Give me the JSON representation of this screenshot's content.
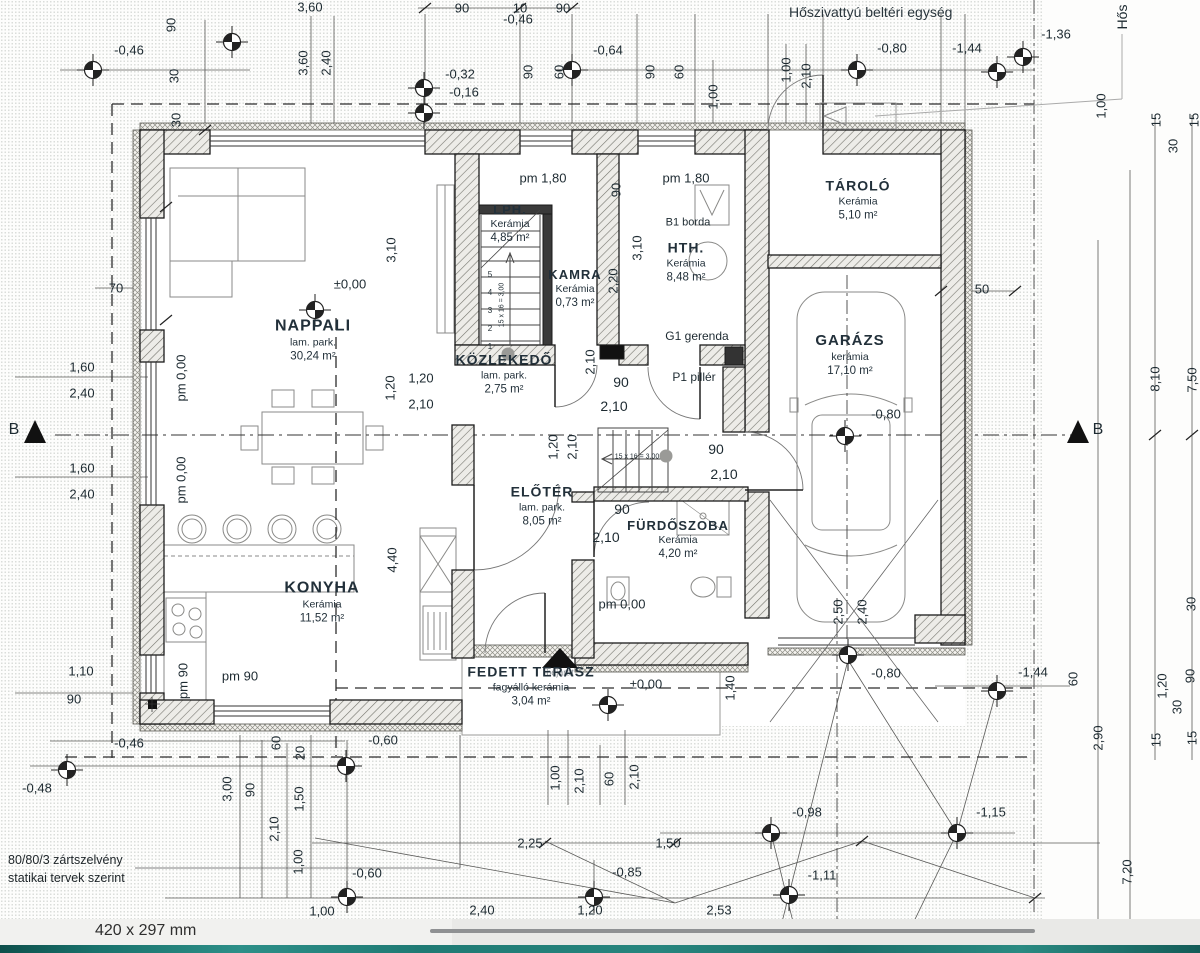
{
  "notes": {
    "hvac": "Hőszivattyú beltéri egység",
    "structural_line1": "80/80/3 zártszelvény",
    "structural_line2": "statikai tervek szerint"
  },
  "statusbar": {
    "paper_size": "420 x 297 mm"
  },
  "colors": {
    "paper": "#fdfdfc",
    "ink": "#1d2a31",
    "hatch": "#76766f",
    "teal_strip": "#1f7a74"
  },
  "rooms": [
    {
      "name": "NAPPALI",
      "finish": "lam. park.",
      "area": "30,24 m²",
      "x": 313,
      "y": 340,
      "ns": 16
    },
    {
      "name": "KONYHA",
      "finish": "Kerámia",
      "area": "11,52 m²",
      "x": 322,
      "y": 602,
      "ns": 16
    },
    {
      "name": "KÖZLEKEDŐ",
      "finish": "lam. park.",
      "area": "2,75 m²",
      "x": 504,
      "y": 374,
      "ns": 14
    },
    {
      "name": "LPH.",
      "finish": "Kerámia",
      "area": "4,85 m²",
      "x": 510,
      "y": 224,
      "ns": 13
    },
    {
      "name": "KAMRA",
      "finish": "Kerámia",
      "area": "0,73 m²",
      "x": 575,
      "y": 289,
      "ns": 13
    },
    {
      "name": "HTH.",
      "finish": "Kerámia",
      "area": "8,48 m²",
      "x": 686,
      "y": 262,
      "ns": 14
    },
    {
      "name": "TÁROLÓ",
      "finish": "Kerámia",
      "area": "5,10 m²",
      "x": 858,
      "y": 200,
      "ns": 14
    },
    {
      "name": "GARÁZS",
      "finish": "kerámia",
      "area": "17,10 m²",
      "x": 850,
      "y": 355,
      "ns": 15
    },
    {
      "name": "ELŐTÉR",
      "finish": "lam. park.",
      "area": "8,05 m²",
      "x": 542,
      "y": 506,
      "ns": 14
    },
    {
      "name": "FÜRDŐSZOBA",
      "finish": "Kerámia",
      "area": "4,20 m²",
      "x": 678,
      "y": 540,
      "ns": 13
    },
    {
      "name": "FEDETT TERASZ",
      "finish": "fagyálló kerámia",
      "area": "3,04 m²",
      "x": 531,
      "y": 686,
      "ns": 14
    }
  ],
  "labels": [
    {
      "t": "3,60",
      "x": 310,
      "y": 7
    },
    {
      "t": "90",
      "x": 462,
      "y": 8
    },
    {
      "t": "10",
      "x": 520,
      "y": 8
    },
    {
      "t": "90",
      "x": 563,
      "y": 8
    },
    {
      "t": "-0,46",
      "x": 518,
      "y": 19
    },
    {
      "t": "-0,46",
      "x": 129,
      "y": 50
    },
    {
      "t": "-0,64",
      "x": 608,
      "y": 50
    },
    {
      "t": "-0,32",
      "x": 460,
      "y": 74
    },
    {
      "t": "-0,16",
      "x": 464,
      "y": 92
    },
    {
      "t": "-0,80",
      "x": 892,
      "y": 48
    },
    {
      "t": "-1,44",
      "x": 967,
      "y": 48
    },
    {
      "t": "-1,36",
      "x": 1056,
      "y": 34
    },
    {
      "t": "-0,80",
      "x": 886,
      "y": 673
    },
    {
      "t": "-1,44",
      "x": 1033,
      "y": 672
    },
    {
      "t": "70",
      "x": 116,
      "y": 288
    },
    {
      "t": "1,60",
      "x": 82,
      "y": 367
    },
    {
      "t": "2,40",
      "x": 82,
      "y": 393
    },
    {
      "t": "1,60",
      "x": 82,
      "y": 468
    },
    {
      "t": "2,40",
      "x": 82,
      "y": 494
    },
    {
      "t": "1,10",
      "x": 81,
      "y": 671
    },
    {
      "t": "90",
      "x": 74,
      "y": 699
    },
    {
      "t": "-0,46",
      "x": 129,
      "y": 743
    },
    {
      "t": "-0,48",
      "x": 37,
      "y": 788
    },
    {
      "t": "pm 90",
      "x": 240,
      "y": 676
    },
    {
      "t": "±0,00",
      "x": 350,
      "y": 284
    },
    {
      "t": "pm 1,80",
      "x": 543,
      "y": 178
    },
    {
      "t": "pm 1,80",
      "x": 686,
      "y": 178
    },
    {
      "t": "50",
      "x": 982,
      "y": 289
    },
    {
      "t": "-0,80",
      "x": 886,
      "y": 414
    },
    {
      "t": "B1 borda",
      "x": 688,
      "y": 223,
      "s": 11
    },
    {
      "t": "G1 gerenda",
      "x": 697,
      "y": 336,
      "s": 12
    },
    {
      "t": "P1 pillér",
      "x": 694,
      "y": 377,
      "s": 12
    },
    {
      "t": "90",
      "x": 621,
      "y": 382,
      "s": 14
    },
    {
      "t": "2,10",
      "x": 614,
      "y": 406,
      "s": 14
    },
    {
      "t": "90",
      "x": 716,
      "y": 449,
      "s": 14
    },
    {
      "t": "2,10",
      "x": 724,
      "y": 474,
      "s": 14
    },
    {
      "t": "90",
      "x": 622,
      "y": 509,
      "s": 14
    },
    {
      "t": "2,10",
      "x": 606,
      "y": 537,
      "s": 14
    },
    {
      "t": "1,20",
      "x": 421,
      "y": 378
    },
    {
      "t": "2,10",
      "x": 421,
      "y": 404
    },
    {
      "t": "pm 0,00",
      "x": 622,
      "y": 604
    },
    {
      "t": "±0,00",
      "x": 646,
      "y": 684
    },
    {
      "t": "bejárat",
      "x": 560,
      "y": 673,
      "s": 9,
      "c": "#8a9096"
    },
    {
      "t": "-0,60",
      "x": 383,
      "y": 740
    },
    {
      "t": "-0,60",
      "x": 367,
      "y": 873
    },
    {
      "t": "-0,85",
      "x": 627,
      "y": 872
    },
    {
      "t": "2,25",
      "x": 530,
      "y": 843
    },
    {
      "t": "1,50",
      "x": 668,
      "y": 843
    },
    {
      "t": "-0,98",
      "x": 807,
      "y": 812
    },
    {
      "t": "-1,15",
      "x": 991,
      "y": 812
    },
    {
      "t": "-1,11",
      "x": 822,
      "y": 875
    },
    {
      "t": "1,00",
      "x": 322,
      "y": 911
    },
    {
      "t": "2,40",
      "x": 482,
      "y": 910
    },
    {
      "t": "1,20",
      "x": 590,
      "y": 910
    },
    {
      "t": "2,53",
      "x": 719,
      "y": 910
    },
    {
      "t": "B",
      "x": 14,
      "y": 430,
      "s": 16
    },
    {
      "t": "B",
      "x": 1098,
      "y": 430,
      "s": 16
    },
    {
      "t": "15 x 16 = 3,00",
      "x": 637,
      "y": 457,
      "s": 7
    },
    {
      "t": "5",
      "x": 490,
      "y": 275,
      "s": 8
    },
    {
      "t": "4",
      "x": 490,
      "y": 293,
      "s": 8
    },
    {
      "t": "3",
      "x": 490,
      "y": 311,
      "s": 8
    },
    {
      "t": "2",
      "x": 490,
      "y": 329,
      "s": 8
    },
    {
      "t": "1",
      "x": 490,
      "y": 347,
      "s": 8
    },
    {
      "t": "90",
      "x": 171,
      "y": 25,
      "r": 1
    },
    {
      "t": "30",
      "x": 174,
      "y": 76,
      "r": 1
    },
    {
      "t": "30",
      "x": 176,
      "y": 120,
      "r": 1
    },
    {
      "t": "3,60",
      "x": 303,
      "y": 63,
      "r": 1
    },
    {
      "t": "2,40",
      "x": 326,
      "y": 63,
      "r": 1
    },
    {
      "t": "90",
      "x": 528,
      "y": 72,
      "r": 1
    },
    {
      "t": "60",
      "x": 559,
      "y": 72,
      "r": 1
    },
    {
      "t": "90",
      "x": 650,
      "y": 72,
      "r": 1
    },
    {
      "t": "60",
      "x": 679,
      "y": 72,
      "r": 1
    },
    {
      "t": "1,00",
      "x": 713,
      "y": 97,
      "r": 1
    },
    {
      "t": "1,00",
      "x": 786,
      "y": 70,
      "r": 1
    },
    {
      "t": "2,10",
      "x": 806,
      "y": 76,
      "r": 1
    },
    {
      "t": "1,00",
      "x": 1101,
      "y": 106,
      "r": 1
    },
    {
      "t": "15",
      "x": 1156,
      "y": 120,
      "r": 1
    },
    {
      "t": "30",
      "x": 1173,
      "y": 146,
      "r": 1
    },
    {
      "t": "15",
      "x": 1194,
      "y": 120,
      "r": 1
    },
    {
      "t": "pm 0,00",
      "x": 181,
      "y": 378,
      "r": 1
    },
    {
      "t": "pm 0,00",
      "x": 181,
      "y": 480,
      "r": 1
    },
    {
      "t": "pm 90",
      "x": 183,
      "y": 681,
      "r": 1
    },
    {
      "t": "3,10",
      "x": 391,
      "y": 250,
      "r": 1
    },
    {
      "t": "1,20",
      "x": 390,
      "y": 388,
      "r": 1
    },
    {
      "t": "90",
      "x": 616,
      "y": 190,
      "r": 1
    },
    {
      "t": "2,20",
      "x": 613,
      "y": 281,
      "r": 1
    },
    {
      "t": "3,10",
      "x": 637,
      "y": 248,
      "r": 1
    },
    {
      "t": "2,10",
      "x": 590,
      "y": 362,
      "r": 1
    },
    {
      "t": "1,20",
      "x": 553,
      "y": 447,
      "r": 1
    },
    {
      "t": "2,10",
      "x": 572,
      "y": 447,
      "r": 1
    },
    {
      "t": "4,40",
      "x": 392,
      "y": 560,
      "r": 1
    },
    {
      "t": "2,50",
      "x": 838,
      "y": 612,
      "r": 1
    },
    {
      "t": "2,40",
      "x": 862,
      "y": 612,
      "r": 1
    },
    {
      "t": "8,10",
      "x": 1155,
      "y": 379,
      "r": 1
    },
    {
      "t": "7,50",
      "x": 1192,
      "y": 380,
      "r": 1
    },
    {
      "t": "60",
      "x": 1073,
      "y": 679,
      "r": 1
    },
    {
      "t": "2,90",
      "x": 1098,
      "y": 738,
      "r": 1
    },
    {
      "t": "7,20",
      "x": 1127,
      "y": 872,
      "r": 1
    },
    {
      "t": "30",
      "x": 1191,
      "y": 604,
      "r": 1
    },
    {
      "t": "90",
      "x": 1190,
      "y": 676,
      "r": 1
    },
    {
      "t": "15",
      "x": 1192,
      "y": 738,
      "r": 1
    },
    {
      "t": "1,20",
      "x": 1162,
      "y": 686,
      "r": 1
    },
    {
      "t": "30",
      "x": 1177,
      "y": 707,
      "r": 1
    },
    {
      "t": "15",
      "x": 1156,
      "y": 740,
      "r": 1
    },
    {
      "t": "3,00",
      "x": 227,
      "y": 789,
      "r": 1
    },
    {
      "t": "90",
      "x": 250,
      "y": 790,
      "r": 1
    },
    {
      "t": "2,10",
      "x": 274,
      "y": 829,
      "r": 1
    },
    {
      "t": "60",
      "x": 276,
      "y": 743,
      "r": 1
    },
    {
      "t": "20",
      "x": 300,
      "y": 753,
      "r": 1
    },
    {
      "t": "1,50",
      "x": 299,
      "y": 799,
      "r": 1
    },
    {
      "t": "1,00",
      "x": 298,
      "y": 862,
      "r": 1
    },
    {
      "t": "1,00",
      "x": 555,
      "y": 778,
      "r": 1
    },
    {
      "t": "2,10",
      "x": 579,
      "y": 781,
      "r": 1
    },
    {
      "t": "60",
      "x": 609,
      "y": 779,
      "r": 1
    },
    {
      "t": "2,10",
      "x": 634,
      "y": 777,
      "r": 1
    },
    {
      "t": "1,40",
      "x": 730,
      "y": 688,
      "r": 1
    },
    {
      "t": "15 x 16 = 3,00",
      "x": 502,
      "y": 305,
      "r": 1,
      "s": 7
    },
    {
      "t": "Hős",
      "x": 1122,
      "y": 17,
      "r": 1,
      "s": 14
    }
  ]
}
